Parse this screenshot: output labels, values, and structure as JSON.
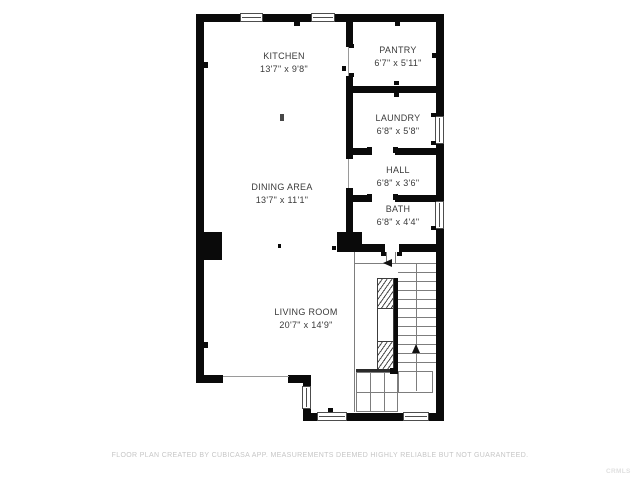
{
  "floorplan": {
    "rooms": [
      {
        "id": "kitchen",
        "name": "KITCHEN",
        "dims": "13'7\" x 9'8\""
      },
      {
        "id": "pantry",
        "name": "PANTRY",
        "dims": "6'7\" x 5'11\""
      },
      {
        "id": "laundry",
        "name": "LAUNDRY",
        "dims": "6'8\" x 5'8\""
      },
      {
        "id": "hall",
        "name": "HALL",
        "dims": "6'8\" x 3'6\""
      },
      {
        "id": "bath",
        "name": "BATH",
        "dims": "6'8\" x 4'4\""
      },
      {
        "id": "dining-area",
        "name": "DINING AREA",
        "dims": "13'7\" x 11'1\""
      },
      {
        "id": "living-room",
        "name": "LIVING ROOM",
        "dims": "20'7\" x 14'9\""
      }
    ],
    "colors": {
      "wall": "#0a0a0a",
      "stair_line": "#7d7d7d",
      "label_text": "#3a3a3a",
      "footer_text": "#c6c6c6"
    },
    "footer_disclaimer": "FLOOR PLAN CREATED BY CUBICASA APP. MEASUREMENTS DEEMED HIGHLY RELIABLE BUT NOT GUARANTEED.",
    "watermark": "CRMLS"
  }
}
